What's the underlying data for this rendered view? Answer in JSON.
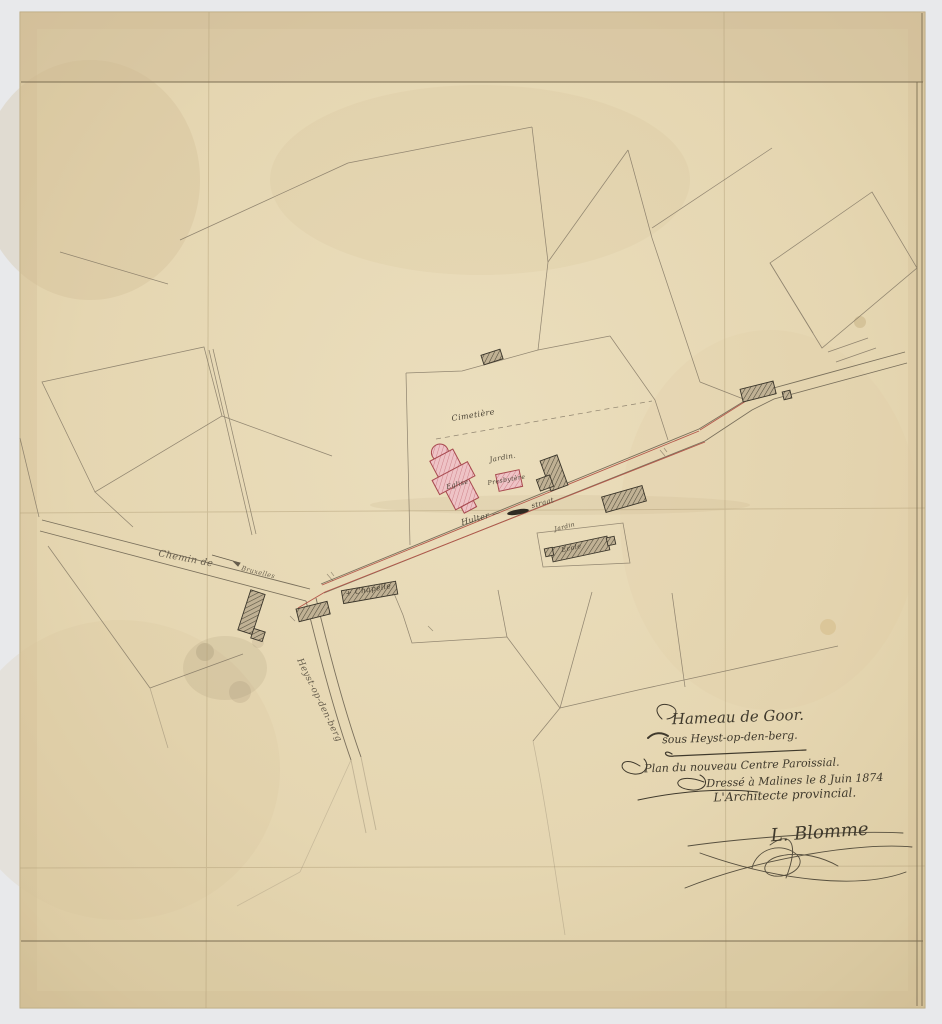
{
  "page": {
    "background": "#e8e9eb"
  },
  "paper": {
    "base_color": "#e6d8b4",
    "edge_color": "#cdb88e",
    "ink_color": "#474031",
    "road_accent_red": "#b4584b",
    "church_pink": "#eec3c6",
    "church_outline": "#a8494f",
    "building_gray": "#c0b194"
  },
  "map": {
    "labels": {
      "cimetiere": "Cimetière",
      "jardin_eglise": "Jardin.",
      "eglise": "Eglise",
      "presbytere": "Presbytère",
      "street_left": "Hulter —",
      "street_right": "straat",
      "jardin_ecole": "Jardin",
      "ecole": "Ecole",
      "chapelle": "+ Chapelle",
      "chemin": "Chemin de",
      "chemin_dest": "Bruxelles",
      "road_south": "Heyst-op-den-berg"
    },
    "title_block": {
      "hamlet": "Hameau de Goor.",
      "commune": "sous Heyst-op-den-berg.",
      "plan": "Plan du nouveau Centre Paroissial.",
      "dateline": "Dressé à Malines le 8 Juin 1874",
      "role": "L'Architecte provincial.",
      "signature": "L. Blomme"
    }
  }
}
